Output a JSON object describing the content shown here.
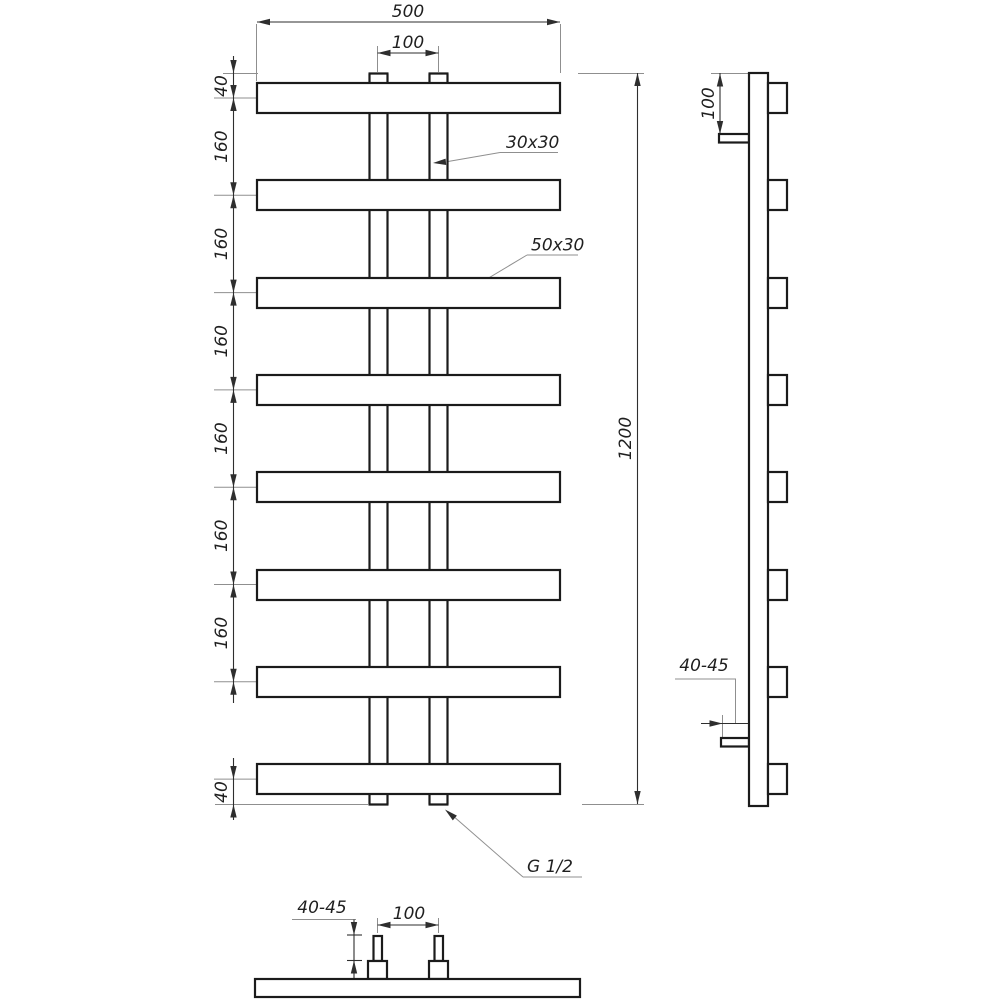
{
  "front_view": {
    "overall_width": "500",
    "connector_pitch": "100",
    "top_offset": "40",
    "rung_spacing": [
      "160",
      "160",
      "160",
      "160",
      "160",
      "160"
    ],
    "bottom_offset": "40",
    "overall_height": "1200",
    "upright_section": "30x30",
    "rung_section": "50x30",
    "thread_size": "G 1/2"
  },
  "side_view": {
    "top_mount_offset": "100",
    "wall_clearance": "40-45"
  },
  "bottom_view": {
    "wall_clearance": "40-45",
    "connector_pitch": "100"
  },
  "style": {
    "line_color": "#1b1b1b",
    "dim_color": "#2e2e2e",
    "thin_color": "#8f8f8f",
    "text_color": "#1f1f1f",
    "background": "#ffffff"
  }
}
